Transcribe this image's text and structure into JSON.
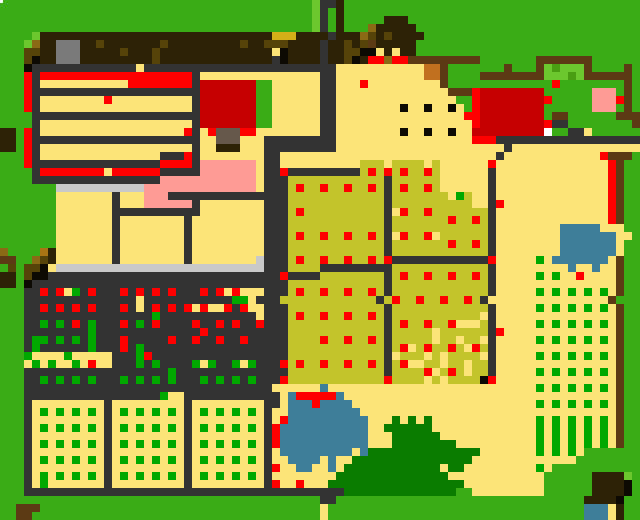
{
  "meta": {
    "title": "pixel-farm-map",
    "width": 640,
    "height": 520,
    "cell_size": 8,
    "grid_cols": 80,
    "grid_rows": 65
  },
  "legend": {
    "G": {
      "name": "grass",
      "color": "#3aac15"
    },
    "g": {
      "name": "light-grass",
      "color": "#6cc72e"
    },
    "m": {
      "name": "bush-shade-green",
      "color": "#4a9e12"
    },
    "E": {
      "name": "crop-sprout-green",
      "color": "#00a800"
    },
    "F": {
      "name": "big-bush-green",
      "color": "#0a7d00"
    },
    "Y": {
      "name": "sand-path",
      "color": "#fde478"
    },
    "S": {
      "name": "silver-counter",
      "color": "#c9c9c9"
    },
    "C": {
      "name": "charcoal-fence-soil",
      "color": "#333333"
    },
    "B": {
      "name": "dark-brown-roof",
      "color": "#2e2206"
    },
    "n": {
      "name": "saddle-brown-fence",
      "color": "#5b3a14"
    },
    "b": {
      "name": "gold-brown",
      "color": "#8a6a14"
    },
    "o": {
      "name": "dark-olive",
      "color": "#55430a"
    },
    "h": {
      "name": "amber",
      "color": "#a87414"
    },
    "D": {
      "name": "gold-bar",
      "color": "#d4af17"
    },
    "U": {
      "name": "taupe-block",
      "color": "#66584a"
    },
    "W": {
      "name": "grey-chimney",
      "color": "#7a7a7a"
    },
    "w": {
      "name": "white",
      "color": "#ffffff"
    },
    "R": {
      "name": "red-produce",
      "color": "#fe0000"
    },
    "r": {
      "name": "dark-red-barn",
      "color": "#c60000"
    },
    "P": {
      "name": "pink-flowers",
      "color": "#ff9b95"
    },
    "O": {
      "name": "olive-crop-field",
      "color": "#c3c32b"
    },
    "L": {
      "name": "pond-blue",
      "color": "#3f7e99"
    },
    "K": {
      "name": "near-black",
      "color": "#0d0a04"
    },
    "q": {
      "name": "orange-crate",
      "color": "#c1701f"
    }
  },
  "white_speck": {
    "x": 0,
    "y": 0,
    "w": 3,
    "h": 3
  },
  "grid": [
    "GGGGGGGGGGGGGGGGGGGGGGGGGGGGGGGGGGGGGGGgCCBGGGGGGGGGGGGGGGGGGGGGGGGGGGGGGGGGGGG",
    "GGGGGGGGGGGGGGGGGGGGGGGGGGGGGGGGGGGGGGGgCGBGGGGGGGGGGGGGGGGGGGGGGGGGGGGGGGGGGGG",
    "GGGGGGGGGGGGGGGGGGGGGGGGGGGGGGGGGGGGGGGgCGBGGGGGBBBGGGGGGGGGGGGGGGGGGGGGGGGGGGG",
    "GGGGGGGGGGGGGGGGGGGGGGGGGGGGGGGGGGGGGGGgCGBGGGbBBBBBGGGGGGGGGGGGGGGGGGGGGGGGGGG",
    "GGGGgBBBBBBBBBBBBBBBBBBBBBBBBBBBBBDDDBBBBCBBBboBoBBBBGGGGGGGGGGGGGGGGGGGGGGGGGG",
    "GGGgbBBWWWBBoBBBBBBBoBBBBBBBBBoBBoooBBBBCBBoBonBBBBBGGGGGGGGGGGGGGGGGGGGGGGGGGG",
    "GGGooBBWWWBBBBBoBBBoBBBBBBBBBBBBBBYKBBBBCBBooKKYBYBBGGGGGGGGGGGGGGGGGGGGGGGGGGG",
    "GGGoKBBWWWBBBBBBBBBoBBBBBBBBBBBBBBCKBBBBCBBoKBRRbRRnnnnnnnnnGGGGGGGnnnnnnnGGGGGG",
    "GGGKCCCCCCCCCCCCCYCCCCCCCCCCCCCCCCCCCCCCCCYYYYYYYYYYYqqnGGGGGGGnGGGngmgggnGGGGnG",
    "GGGRCRRRRRRRRRRRRRRRRRRRCYYYYYYYYYYYYYYYCCYYYYYYYYYYYqqnGGGGnnnnnnnngggmgnnnnnnG",
    "GGGRCYYYYYYYYYYYRRRRRRRRCrrrrrrrGGYYYYYYCCYYYRYYYYYYYYYnGGGGGGGGGGGGGRGGGGGGGGnG",
    "GGGRCCCCCCCCCCCCCCCCCCCCCrrrrrrrGGYYYYYYCCYYYYYYYYYYYYYYnnnRrrrrrrrrGGGGGGPPPGnG",
    "GGGRCYYYYYYYYRYYYYYYYYYYCrrrrrrrGGYYYYYYCCYYYYYYYYYYYYYYYGGRrrrrrrrrRGGGGGPPPRnG",
    "GGGRCYYYYYYYYYYYYYYYYYYYCrrrrrrrGGYYYYYYCCYYYYYYYYKYYKYYKYGRrrrrrrrrGGGGGGPPPGnG",
    "GGGGCCCCCCCCCCCCCCCCCCCCCrrrrrrrGGYYYYYYCCYYYYYYYYYYYYYYYYRRrrrrrrrrGnnGGGGGGnnn",
    "GGGGCYYYYYYYYYYYYYYYYYYYCrrrrrrrGGYYYYYYCCYYYYYYYYYYYYYYYYYRrrrrrrrrRCCGGGGGGGGn",
    "BBGRCYYYYYYYYYYYYYYYYYYRCYRUUURRYYYYYYYYCCYYYYYYYYKYYKYYKYYrrrrrrrrrwGGCCYGGGGGG",
    "BBGRCCCCCCCCCCCCCCCCCCCCCYYUUUYYYCCCCCCCCCYYYYYYYYYYYYYYYYYRRRCCCCCCCCCCCCCCCCCC",
    "BBGRCYYYYYYYYYYYYYYYYYYYCYYBBBYYYCCCCCCCCCYYYYYYYYYYYYYYYYYYYYYCYYYYYYYYYYYYYYYY",
    "GGGRCYYYYYYYYYYYYYYYCCCRCYYYYYYYYCCYYYYYYYYYYYYYYYYYYYYYYYYYYYCYYYYYYYYYYYYRnnn",
    "GGGRCCCCCCCCCCCCCCCCRRRRCPPPPPPPYCCYYYYYYYYYYOOOYOOOOYOYYYYYYRYYYYYYYYYYYYYYRnGG",
    "GGGGCRRRRRRRRYRRRRRRCCCCCPPPPPPPYCCRCCCCCCCCCOROROROOROYYYYYYCYYYYYYYYYYYYYYRnGG",
    "GGGGCCCCCCCCCCCCCCCCPPPPPPPPPPPPYCCCOOOOOOOOOOOOCOOOOOOYYYYYYCYYYYYYYYYYYYYYRnGG",
    "GGGGGGGSSSSSSSSSSSPPPPPPPPPPPPPPYCCCOROOROOROOROCOROOROYYYYYYCYYYYYYYYYYYYYYRnGG",
    "GGGGGGGYYYYYYYCYYYPPPCCCCCCCCCCCCCCCOOOOOOOOOOOOCOOOOOOOYEOYYCYYYYYYYYYYYYYYRnGG",
    "GGGGGGGYYYYYYYCYYYPPPPPPCYYYYYYYYCCCOOOOOOOOOOOOCOOOOOOOOOOYYCRYYYYYYYYYYYYYRnGG",
    "GGGGGGGYYYYYYYCCCCCCCCCCCYYYYYYYYCCCOROOOOOOOOOOCYROOROOOOOOOCYYYYYYYYYYYYYYRnGG",
    "GGGGGGGYYYYYYYCYYYYYYYYCYYYYYYYYYCCCOOOOOOOOOOOOCOOOOOOOROOROCYYYYYYYYYYYYYYRnGG",
    "GGGGGGGYYYYYYYCYYYYYYYYCYYYYYYYYYCCCOOOOOOOOOOOOCOOOOOOOOOOOOCYYYYYYYYLLLLLYYYGG",
    "GGGGGGGYYYYYYYCYYYYYYYYCYYYYYYYYYCCCOROOROOROOROCYROORYOOOOOOCYYYYYYYYLLLLLLLYYG",
    "GGGGGGGYYYYYYYCYYYYYYYYCYYYYYYYYYCCCOOOOOOOOOOOOCOOOOOOOROOROCYYYYYYYYLLLLLLLYGG",
    "bGGGGhBYYYYYYYCYYYYYYYYCYYYYYYYYYCCCOOOOOOOOOOOOCOOOOOOOOOOOOCYYYYYYYYLLLLLLLYGG",
    "nnGGboBYYYYYYYCYYYYYYYYCYYYYYYYYSCCCOROOROOROORORCCCCCCCCCCCCRYYYYYEYLLLLLLLYnGG",
    "GoGooKYSSSSSSSSSSSSSSSSSSSSSSSSSSCCCOOOOCCCCCCCCCOOOOOOOOOOOOCYYYYYYYYYLYYLYYnGG",
    "BBGoKKCCCCCCCCCCCCCCCCCCCCCCCCCCCCCRCCCCOOOOOOOOCOROOROOROOROCYYYYYEYEYYRYYYYnGG",
    "BBGKCCCCCCCCCCCCCCCCCCCCCCCCCCCCCCCCOOOOOOOOOOOOCOOOOOOOOOOOOCYYYYYYYYYYYYYYYnGG",
    "GGGCCRCRYECRCCCRCRCRCRCCCRCRYRYYYCCCOROOROOROOROCOOOOOOOOOOOOCYYYYYEYEYEYEYEYnGG",
    "GGGCCCCCCCCCCCCCCYCCCCCCCCCCCEEYCCCOOOOOOOOOOOOCOROOROOROOROCYYYYYYYYYYYYYYYnGG",
    "GGGCCRCRCRCRCCCRCYCRCRCRYRYYRCRYYCCCOOOOOOOOOOOOCOOOOOOOOOOOOCYYYYYEYEYEYEYEYnGG",
    "GGGCCCCCCCCCCCCCCCCECCCCCCCCCCCCYCCCOROOROOROOROCOOOOOOOOOOOYCYYYYYYYYYYYYYYYnGG",
    "GGGCCECECRCECCCRCECRCCCCRCCRCRCCRCCCOOOOOOOOOOOOCOROOROORYYYOCYYYYYEYEYEYEYEYnGG",
    "GGGCCCCCCCCECCCCCCCCCCCCCRCCCCCCCCCCOOOOOOOOOOOOCOOOOOYOOOOOOCRYYYYYYYYYYYYYYnGG",
    "GGGCEECECECECCCRCCCCCRCCRCCRCCRCCCCCOOOOROOROOROCOOOOOYOOYOOYCYYYYYEYEYEYEYEYnGG",
    "GGGCECCCCCCECCCRCECCCCCCCCCCCCCCCCCCOOOOOOOOOOOOCORYOROOROYROCYYYYYYYYYYYYYYYnGG",
    "GGGEYYYYEYYYYYCCCERCCCCCCCCCCCCCCCCCOOOOOOOOOOOOCYOOOYOYOOOOYCYYYYYEYEYEYEYEYnGG",
    "GGGYEYEYYEYRYYCCCECECCCCEYECCEYECCCROROOROOROOROCORYYOOYOOYOOCYYYYYYYYYYYYYYYnGG",
    "GGGCCCCCCCCCCCCCCCCCCECCCCCCCCCCCCCCOOOOOOOOOOOOCOOOORYOROYOOCYYYYYEYEYEYEYEYnGG",
    "GGGCCECECECECCCECECECECCCECECECECCCROOOOOOOOOOOOROOOOYOYOOOOKRYYYYYYYYYYYYYYYnGG",
    "GGGCCCCCCCCCCCCCCCCCCCCCCCCCCCCCCCYYYYYYLYYYYYYYYYYYYYYYYYYYYYYYYYYEYEYEYEYEYnGG",
    "GGGCCCCCCCCCCCCCCCCCEYYCCCCCCCCCCCCYLRRRRRLYYYYYYYYYYYYYYYYYYYYYYYYYYYYYYYYYYnGG",
    "GGGCYYYYYYYYYCYYYYYYYYYCYYYYYYYYYCCYLLLRLLLLYYYYYYYYYYYYYYYYYYYYYYYEYEYEYEYEYnGG",
    "GGGCYEYEYEYEYCYEYEYEYEYCYEYEYEYEYCYYLLLLLLLLLYYYYYYYYYYYYYYYYYYYYYYYYYYYYYYYYnGG",
    "GGGCYYYYYYYYYCYYYYYYYYYCYYYYYYYYYCYRLLLLLLLLLLYYYFYFYFYYYYYYYYYYYYYEYEYEYEYEYnGG",
    "GGGCYEYEYEYEYCYEYEYEYEYCYEYEYEYEYCRLLLLLLLLLLLYYFFFFFFYYYYYYYYYYYYYEYEYEYEYEYnGG",
    "GGGCYYYYYYYYYCYYYYYYYYYCYYYYYYYYYCRLLLLLLLLLLLYYYFFFFFFYYYYYYYYYYYYEYEYEYEYEYnGG",
    "GGGCYEYEYEYEYCYEYEYEYEYCYEYEYEYEYCRLLLLLLLLLLLYYYFFFFFFFFYYYYYYYYYYEYEYEYEYEYnGG",
    "GGGCYYYYYYYYYCYYYYYYYYYCYYYYYYYYYCYLLLLLLLLLYLFFFFFFFFFFFFFFYYYYYYYEYEYEYGGGGGGG",
    "GGGCYEYEYEYEYCYEYEYEYEYCYEYEYEYEYCYYLLLLYLYYFFFFFFFFFFFFFFFYYYYYYYYYYYYYGGGGGGG G",
    "GGGCYYYYYYYYYCYYYYYYYYYCYYYYYYYYYCRYYLLYYLYFFFFFFFFFFFFYFFYYYYYYYYYEYGGGGGGGGGGG",
    "GGGCYEYEYEYEYCYEYEYEYEYCYEYEYEYEYCYYYYYYYYFFFFFFFFFFFFFFYYYYYYYYYYYYGGGGGGBBBBg",
    "GGGCYEYYYYYYYCYYYYYYYYYCYYYYYYYYYCRYYRYYYFFFFFFFFFFFFFFFFFYYYYYYYYYYGGGGGGBBBBK",
    "GGGCCCCCCCCCCCCCCCCCCCCCCCCCCCCCCCCCCCCCCCCFFFFFFFFFFFFFFGGYYYYYYYYYGGGGGGBBBBK",
    "GGGGGGGGGGGGGGGGGGGGGGGGGGGGGGGGGGGGGGGGCCGGGGGGGGGGGGGGGGGGGGGGGGGGGGGGGBBBBK",
    "GGnnnGGGGGGGGGGGGGGGGGGGGGGGGGGGGGGGGGGGYGGGGGGGGGGGGGGGGGGGGGGGGGGGGGGGGLLLYB",
    "GGnnGGGGGGGGGGGGGGGGGGGGGGGGGGGGGGGGGGGGYGGGGGGGGGGGGGGGGGGGGGGGGGGGGGGGGLLLYB"
  ]
}
